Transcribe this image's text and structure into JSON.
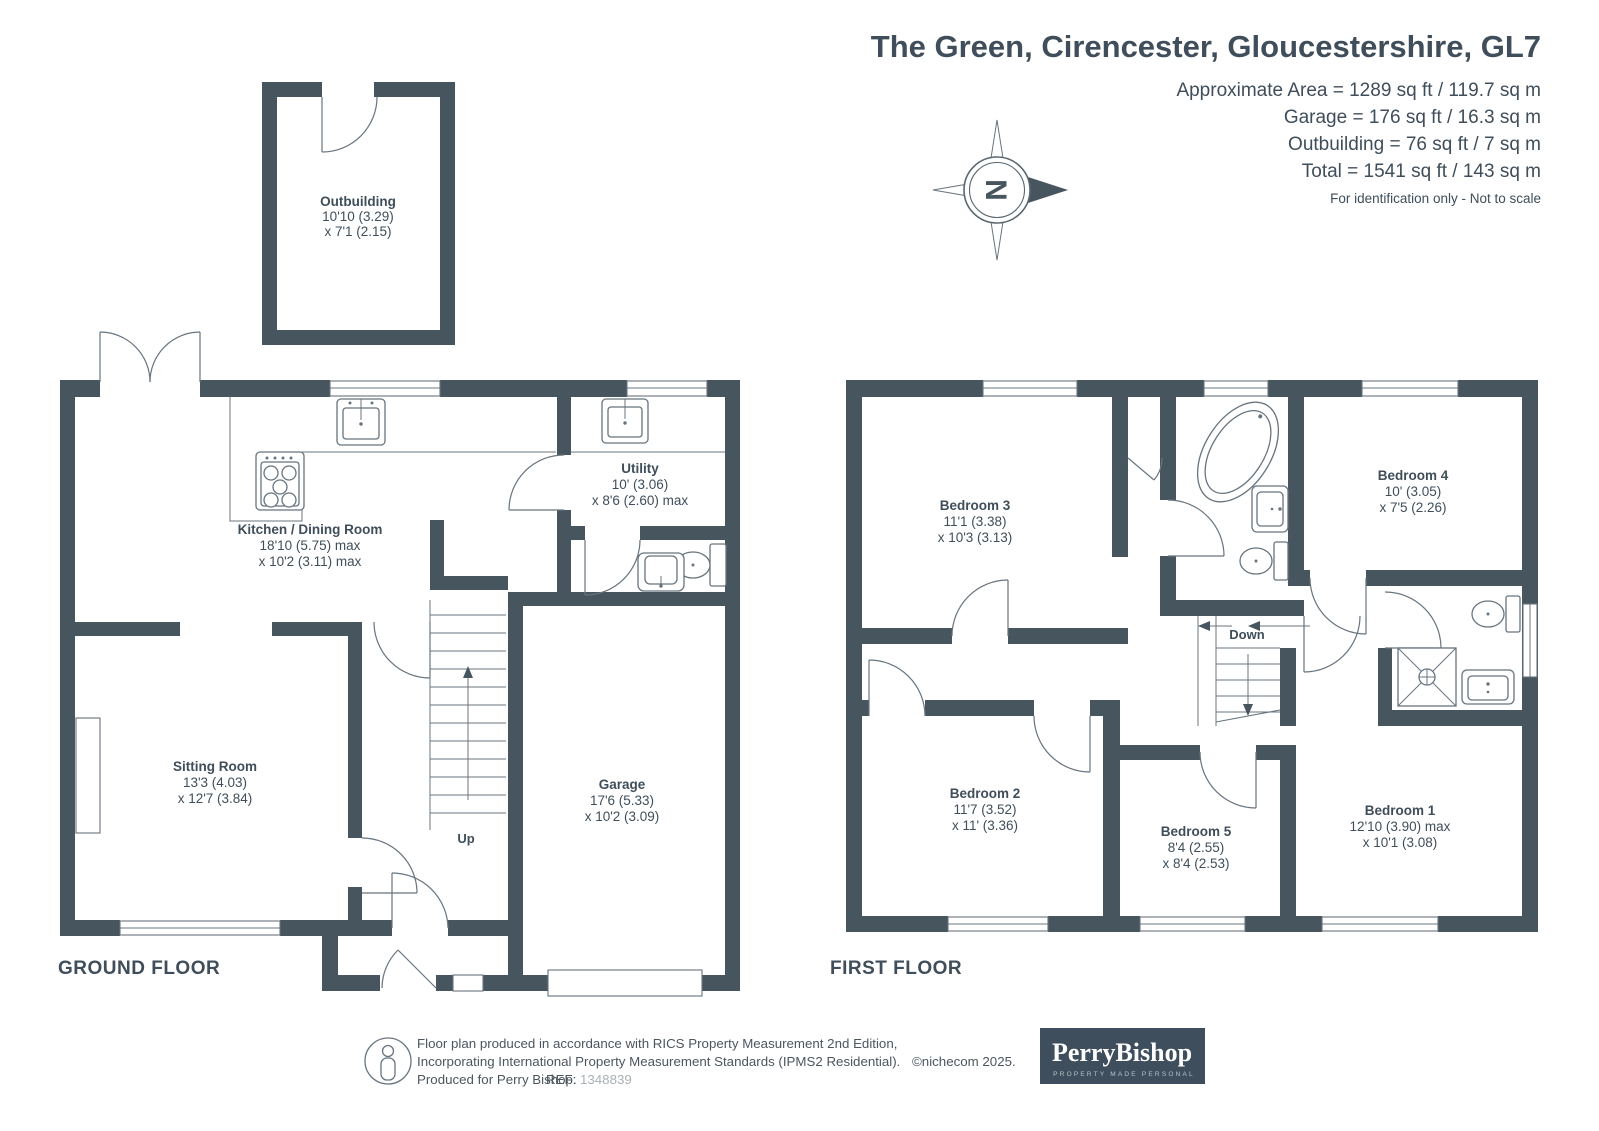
{
  "header": {
    "title": "The Green, Cirencester, Gloucestershire, GL7",
    "area_lines": [
      "Approximate Area = 1289 sq ft / 119.7 sq m",
      "Garage = 176 sq ft / 16.3 sq m",
      "Outbuilding = 76 sq ft / 7 sq m",
      "Total = 1541 sq ft / 143 sq m"
    ],
    "disclaimer": "For identification only - Not to scale"
  },
  "compass": {
    "letter": "N"
  },
  "floors": {
    "ground": {
      "label": "GROUND FLOOR"
    },
    "first": {
      "label": "FIRST FLOOR"
    }
  },
  "stairs": {
    "up": "Up",
    "down": "Down"
  },
  "rooms": {
    "outbuilding": {
      "name": "Outbuilding",
      "dim1": "10'10 (3.29)",
      "dim2": "x 7'1 (2.15)"
    },
    "kitchen": {
      "name": "Kitchen / Dining Room",
      "dim1": "18'10 (5.75) max",
      "dim2": "x 10'2 (3.11) max"
    },
    "utility": {
      "name": "Utility",
      "dim1": "10' (3.06)",
      "dim2": "x 8'6 (2.60) max"
    },
    "sitting": {
      "name": "Sitting Room",
      "dim1": "13'3 (4.03)",
      "dim2": "x 12'7 (3.84)"
    },
    "garage": {
      "name": "Garage",
      "dim1": "17'6 (5.33)",
      "dim2": "x 10'2 (3.09)"
    },
    "bedroom1": {
      "name": "Bedroom 1",
      "dim1": "12'10 (3.90) max",
      "dim2": "x 10'1 (3.08)"
    },
    "bedroom2": {
      "name": "Bedroom 2",
      "dim1": "11'7 (3.52)",
      "dim2": "x 11' (3.36)"
    },
    "bedroom3": {
      "name": "Bedroom 3",
      "dim1": "11'1 (3.38)",
      "dim2": "x 10'3 (3.13)"
    },
    "bedroom4": {
      "name": "Bedroom 4",
      "dim1": "10' (3.05)",
      "dim2": "x 7'5 (2.26)"
    },
    "bedroom5": {
      "name": "Bedroom 5",
      "dim1": "8'4 (2.55)",
      "dim2": "x 8'4 (2.53)"
    }
  },
  "footer": {
    "line1": "Floor plan produced in accordance with RICS Property Measurement 2nd Edition,",
    "line2": "Incorporating International Property Measurement Standards (IPMS2 Residential).",
    "copyright": "©nichecom 2025.",
    "line3": "Produced for Perry Bishop.",
    "ref_label": "REF:",
    "ref_number": "1348839",
    "logo_name": "PerryBishop",
    "logo_tagline": "PROPERTY MADE PERSONAL"
  }
}
